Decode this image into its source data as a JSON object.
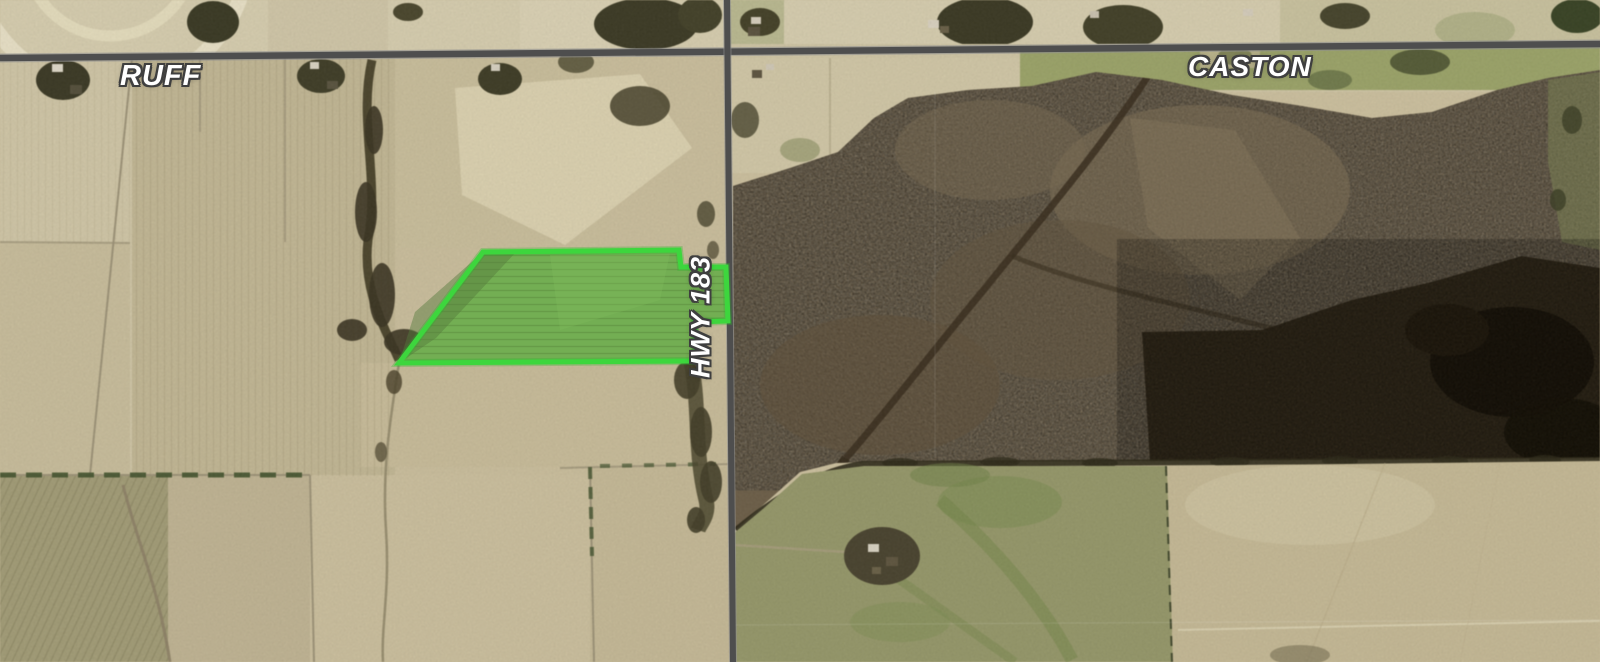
{
  "map": {
    "imagery": "satellite-farmland",
    "labels": {
      "road_west": "RUFF",
      "road_east": "CASTON",
      "highway": "HWY 183"
    },
    "colors": {
      "parcel_outline": "#3dd63d",
      "parcel_fill": "#73ae53",
      "road": "#4e4e4e",
      "field_tan": "#c9bd9c",
      "scrub_brown": "#6d5f49",
      "woods_dark": "#2c2315"
    }
  }
}
